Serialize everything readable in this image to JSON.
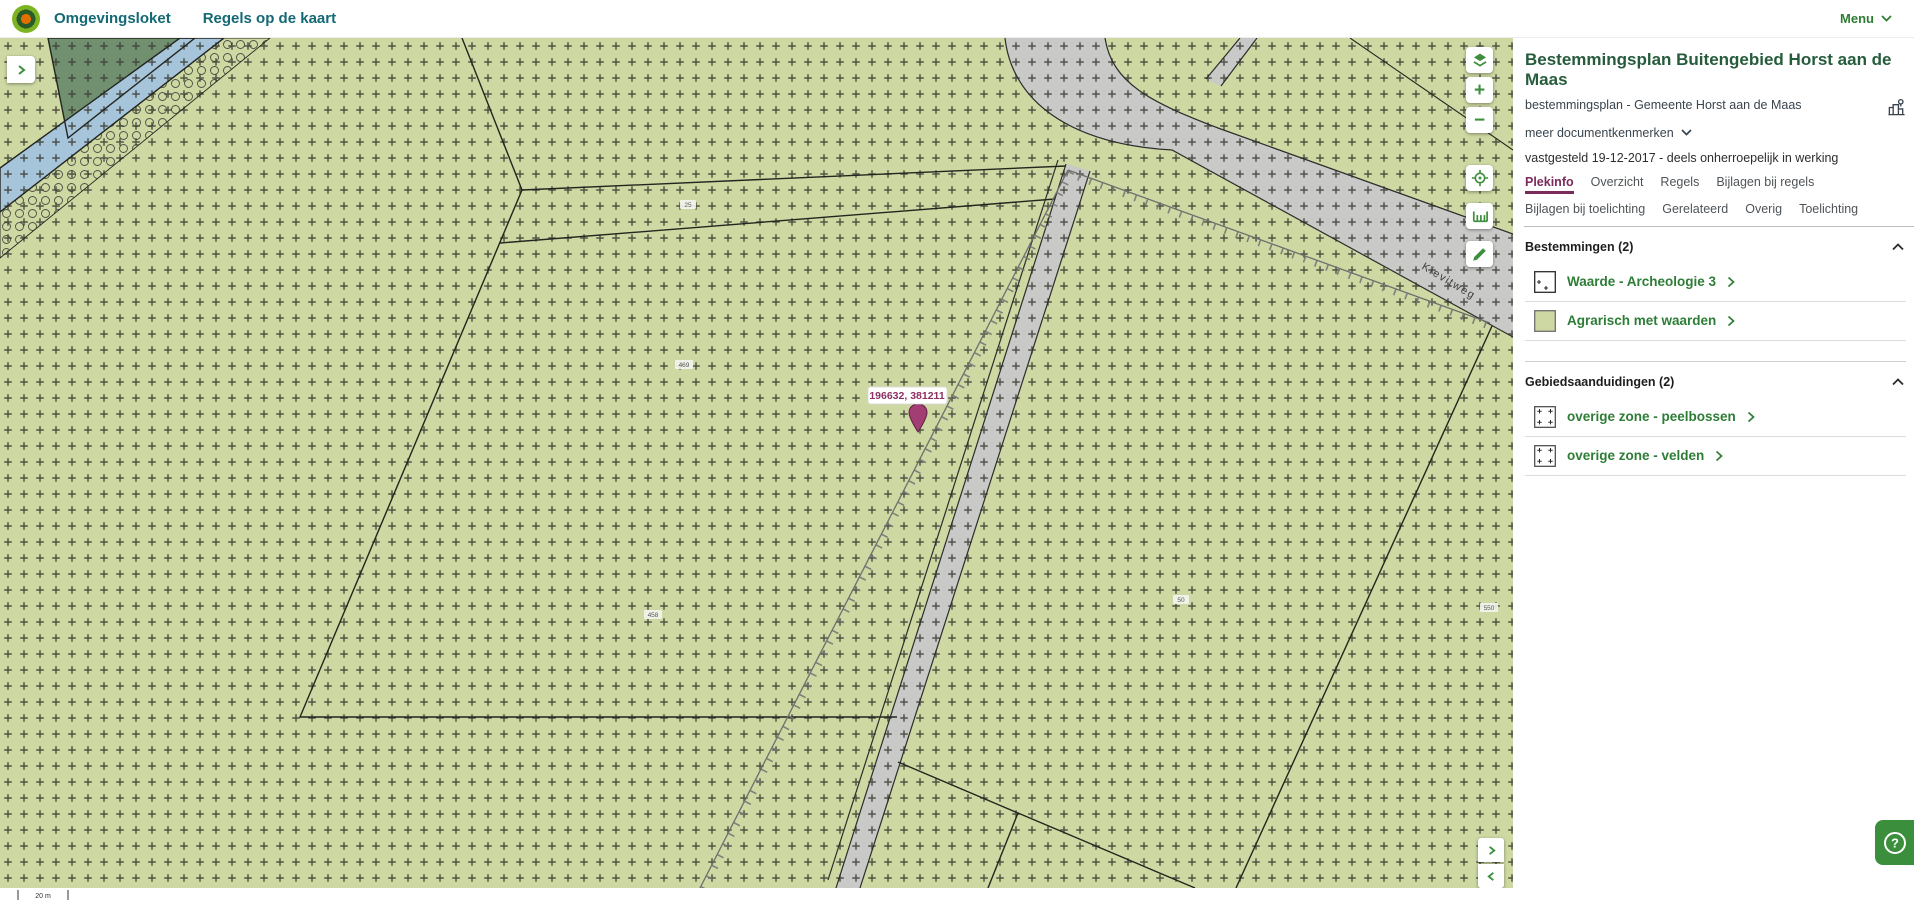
{
  "header": {
    "app_name": "Omgevingsloket",
    "nav_item": "Regels op de kaart",
    "menu_label": "Menu"
  },
  "panel": {
    "title": "Bestemmingsplan Buitengebied Horst aan de Maas",
    "subtitle": "bestemmingsplan - Gemeente Horst aan de Maas",
    "more_link": "meer documentkenmerken",
    "status_line": "vastgesteld 19-12-2017 - deels onherroepelijk in werking",
    "tabs": [
      "Plekinfo",
      "Overzicht",
      "Regels",
      "Bijlagen bij regels",
      "Bijlagen bij toelichting",
      "Gerelateerd",
      "Overig",
      "Toelichting"
    ],
    "active_tab": "Plekinfo",
    "sections": [
      {
        "title": "Bestemmingen (2)",
        "items": [
          {
            "label": "Waarde - Archeologie 3",
            "swatch": "archeologie-pattern"
          },
          {
            "label": "Agrarisch met waarden",
            "swatch": "green-fill"
          }
        ]
      },
      {
        "title": "Gebiedsaanduidingen (2)",
        "items": [
          {
            "label": "overige zone - peelbossen",
            "swatch": "plus-pattern"
          },
          {
            "label": "overige zone - velden",
            "swatch": "plus-pattern"
          }
        ]
      }
    ]
  },
  "map": {
    "coordinate_label": "196632, 381211",
    "street_label": "Kievitweg",
    "scale_label": "20 m",
    "parcel_labels": [
      "25",
      "469",
      "458",
      "50",
      "550"
    ]
  },
  "map_controls": {
    "zoom_in": "+",
    "zoom_out": "−",
    "help": "?"
  },
  "colors": {
    "brand_teal": "#136974",
    "accent_green": "#2e7d36",
    "menu_green": "#2f7d33",
    "active_tab_berry": "#7a2b5b",
    "map_background": "#cdd8a2",
    "road_gray": "#c9c9c7",
    "water_blue": "#a6c4da",
    "forest_green": "#71906f",
    "marker_berry": "#a23e73"
  }
}
